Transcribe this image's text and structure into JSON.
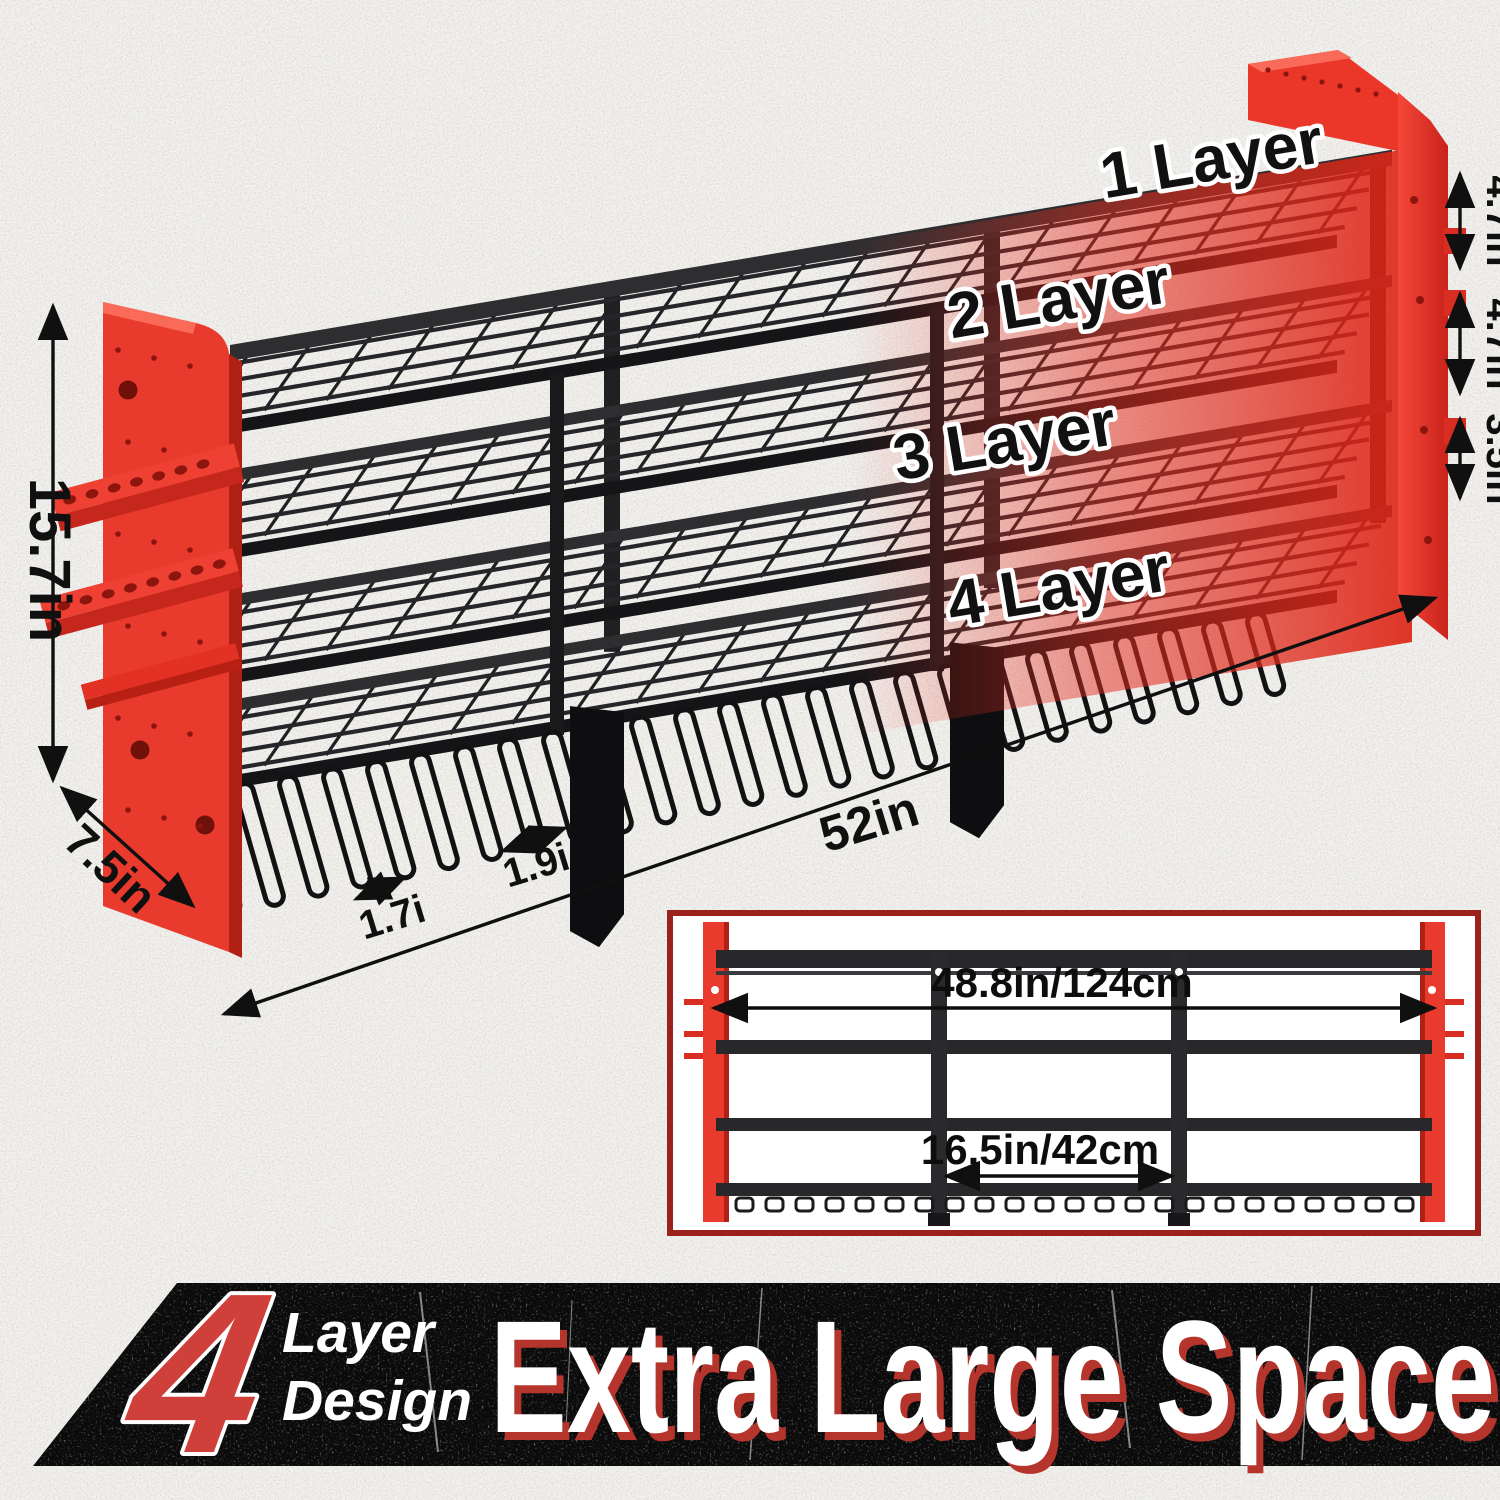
{
  "annotations": {
    "layers": [
      "1 Layer",
      "2 Layer",
      "3 Layer",
      "4 Layer"
    ],
    "gap_top": "4.7in",
    "gap_mid": "4.7in",
    "gap_bottom": "3.5in",
    "height": "15.7in",
    "depth": "7.5in",
    "length": "52in",
    "slot_small": "1.7i",
    "slot_large": "1.9i"
  },
  "inset": {
    "overall_width": "48.8in/124cm",
    "center_width": "16.5in/42cm"
  },
  "banner": {
    "big_number": "4",
    "sub_line1": "Layer",
    "sub_line2": "Design",
    "headline": "Extra Large Space"
  },
  "colors": {
    "red": "#ee3a2c",
    "red_dark": "#b02015",
    "metal": "#1c1c1f",
    "wall": "#f3f2ef",
    "banner_bg": "#0b0b0b",
    "banner_red": "#ce4039",
    "headline_shadow": "#b5352d",
    "inset_border": "#9b221c"
  }
}
